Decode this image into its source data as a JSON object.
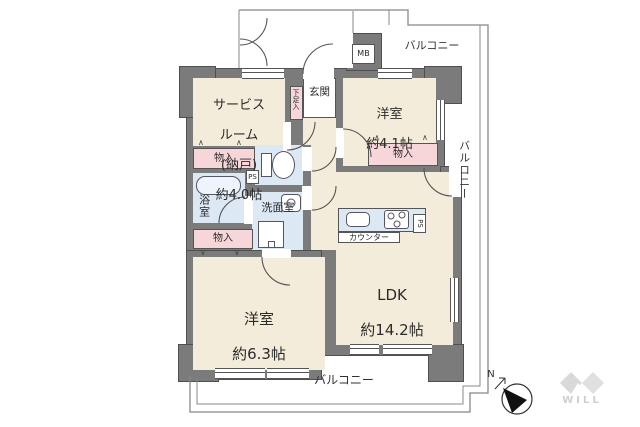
{
  "floorplan": {
    "service_room": {
      "l1": "サービス",
      "l2": "ルーム",
      "l3": "(納戸)",
      "l4": "約4.0帖"
    },
    "western_small": {
      "l1": "洋室",
      "l2": "約4.1帖"
    },
    "western_large": {
      "l1": "洋室",
      "l2": "約6.3帖"
    },
    "ldk": {
      "l1": "LDK",
      "l2": "約14.2帖"
    },
    "entrance": "玄関",
    "shoe_storage": "下足入",
    "bathroom": "浴室",
    "washroom": "洗面室",
    "storage_top_left": "物入",
    "storage_bottom_left": "物入",
    "storage_right": "物入",
    "counter": "カウンター",
    "meter_box": "MB",
    "pipe_space_bath": "PS",
    "pipe_space_kitchen": "PS",
    "balcony_top": "バルコニー",
    "balcony_right": "バルコニー",
    "balcony_bottom": "バルコニー",
    "compass_north": "N",
    "brand": "WILL"
  },
  "icons": {
    "folding_door_up": "∧",
    "folding_door_down": "∨"
  },
  "colors": {
    "wall": "#7b7b7b",
    "floor": "#f4ecda",
    "storage": "#f7d6da",
    "wet_area": "#dce8f4",
    "outline": "#555555",
    "balcony_line": "#888888",
    "watermark": "#d6d6d6"
  }
}
